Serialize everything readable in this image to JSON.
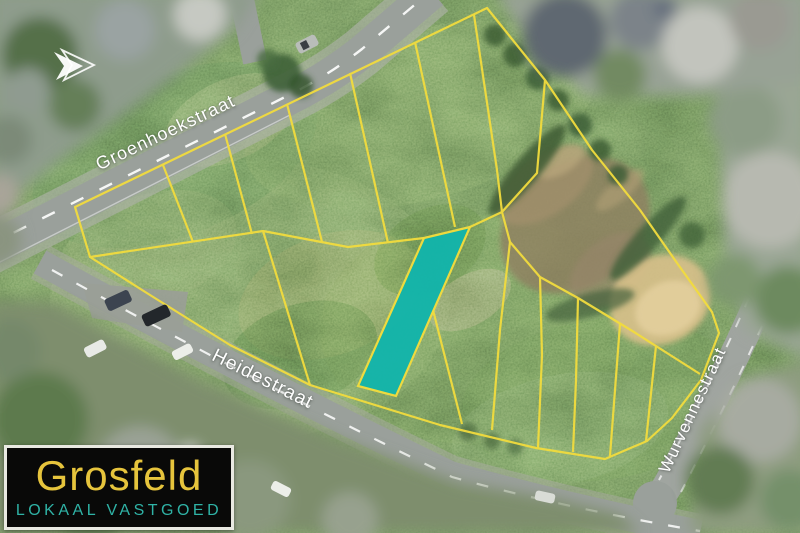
{
  "map": {
    "streets": [
      {
        "name": "Groenhoekstraat"
      },
      {
        "name": "Heidestraat"
      },
      {
        "name": "Wurvennestraat"
      }
    ],
    "highlighted_parcel": {
      "status": "highlighted"
    },
    "label_color": "#ffffff"
  },
  "colors": {
    "parcel_line": "#f2dc3e",
    "highlight_parcel": "#12b5ab",
    "logo_brand": "#e6c43c",
    "logo_tagline": "#2fb3a6",
    "logo_background": "#090908"
  },
  "logo": {
    "brand": "Grosfeld",
    "tagline": "LOKAAL VASTGOED"
  },
  "icons": {
    "arrow": "➤"
  }
}
